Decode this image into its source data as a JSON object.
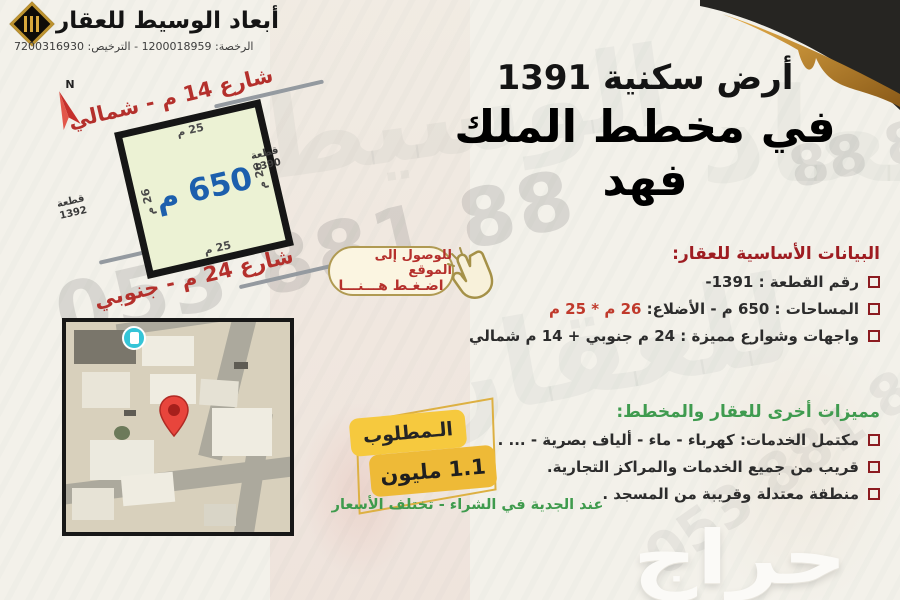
{
  "header": {
    "brand_name": "أبعاد الوسيط للعقار",
    "license_line": "الرخصة: 1200018959 - الترخيص: 7200316930"
  },
  "compass": {
    "label": "N"
  },
  "title": {
    "line1": "أرض سكنية 1391",
    "line2": "في مخطط الملك فهد"
  },
  "plot": {
    "area_label": "650 م",
    "dim_top": "25 م",
    "dim_bottom": "25 م",
    "dim_left": "26 م",
    "dim_right": "26 م",
    "street_north": "شارع 14 م - شمالي",
    "street_south": "شارع 24 م - جنوبي",
    "neighbor_right_title": "قطعة",
    "neighbor_right_number": "1390",
    "neighbor_left_title": "قطعة",
    "neighbor_left_number": "1392"
  },
  "location_badge": {
    "line1": "للوصول إلى الموقع",
    "line2": "اضـغـط هـــنـــا",
    "icon": "pointing-hand-icon"
  },
  "basic_info": {
    "heading": "البيانات الأساسية للعقار:",
    "items": [
      {
        "text": "رقم القطعة : 1391-"
      },
      {
        "prefix": "المساحات : 650 م - الأضلاع: ",
        "highlight": "26 م * 25 م"
      },
      {
        "text": "واجهات وشوارع مميزة : 24 م جنوبي + 14 م شمالي"
      }
    ]
  },
  "features": {
    "heading": "مميزات أخرى للعقار والمخطط:",
    "items": [
      "مكتمل الخدمات: كهرباء - ماء - ألياف بصرية - ... .",
      "قريب من جميع الخدمات والمراكز التجارية.",
      "منطقة معتدلة وقريبة من المسجد ."
    ]
  },
  "price_badge": {
    "label": "الـمطلوب",
    "value": "1.1 مليون"
  },
  "note": {
    "text": "عند الجدية في الشراء - تختلف الأسعار"
  },
  "watermarks": {
    "phone_diagonal": "053 881 88",
    "phone_fragment": "88 88",
    "phone_faint": "053 881 88",
    "calligraphy1": "الوسيط",
    "calligraphy2": "للعقار",
    "calligraphy3": "أبعاد",
    "haraj_logo": "حراج"
  },
  "colors": {
    "background": "#f3f1ea",
    "plot_fill": "#ecf2d4",
    "plot_border": "#161616",
    "area_blue": "#1c5fad",
    "street_red": "#b4302c",
    "heading_red": "#9e1c21",
    "heading_green": "#3f9b4f",
    "highlight_red": "#c0392b",
    "checkbox_red": "#8c1b20",
    "badge_gold_border": "#b09a52",
    "badge_cream": "#fbf5e1",
    "price_yellow_top": "#f6c93e",
    "price_yellow_bottom": "#eeba37",
    "pin_red": "#e8453c",
    "poi_cyan": "#35c4d7",
    "logo_gold": "#bd9330"
  }
}
